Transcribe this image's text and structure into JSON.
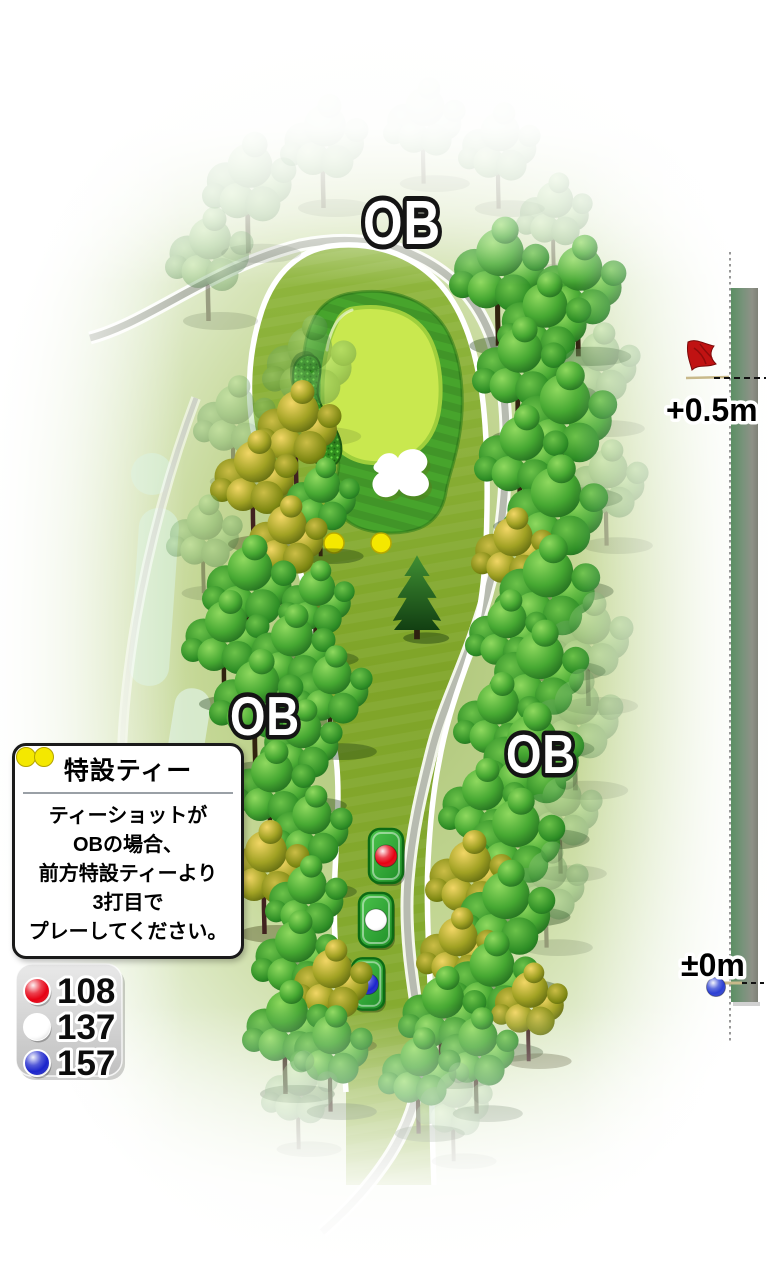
{
  "hole_map": {
    "ob_label": "OB",
    "elevation_gauge": {
      "upper_label": "+0.5m",
      "lower_label": "±0m",
      "flag_color": "#c01212",
      "ball_color": "#2b3fd4"
    },
    "special_tee_note": {
      "dot_color": "#f4e800",
      "title": "特設ティー",
      "lines": [
        "ティーショットが",
        "OBの場合、",
        "前方特設ティーより",
        "3打目で",
        "プレーしてください。"
      ]
    },
    "tees": [
      {
        "name": "red-tee",
        "color": "#e60012",
        "distance": "108"
      },
      {
        "name": "white-tee",
        "color": "#ffffff",
        "distance": "137"
      },
      {
        "name": "blue-tee",
        "color": "#1b24cc",
        "distance": "157"
      }
    ],
    "surface_colors": {
      "fairway": "#82a62b",
      "green_apron": "#47a42c",
      "putting_green": "#c9e84f",
      "grass_bunker": "#2f8c1e",
      "sand_bunker": "#ffffff",
      "cart_path": "#b7bbb0"
    }
  }
}
